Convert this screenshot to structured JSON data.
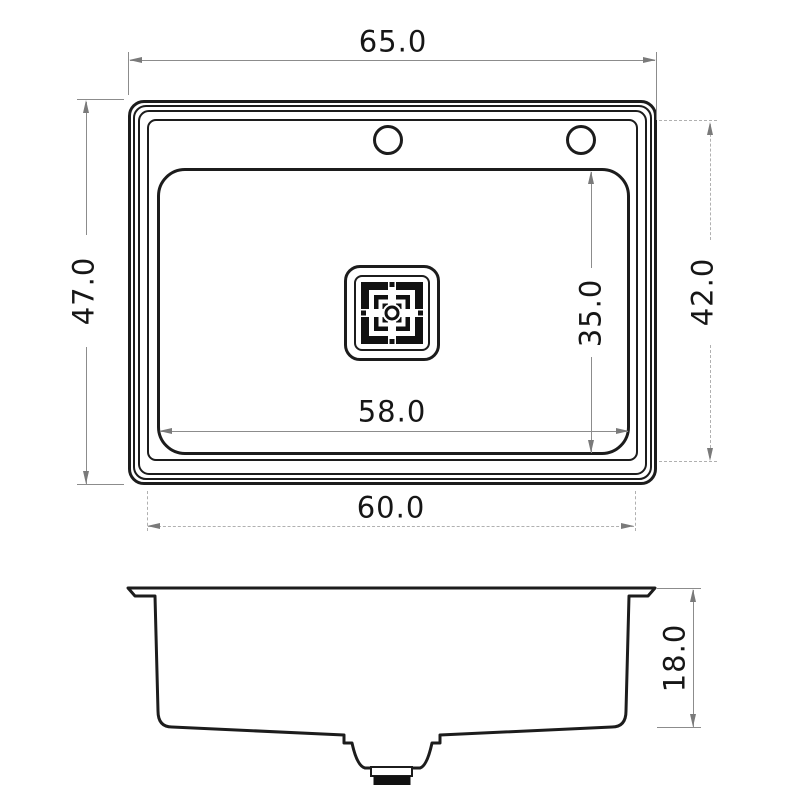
{
  "drawing": {
    "type": "sink-technical-drawing",
    "views": {
      "top": "top-view",
      "side": "side-section-view"
    },
    "units_note": "",
    "colors": {
      "object_line": "#1c1c1c",
      "dimension_line": "#8c8c8c",
      "dashed_line": "#b0b0b0",
      "arrow": "#7a7a7a",
      "text": "#161616",
      "background": "#ffffff",
      "drain_fill": "#111111"
    }
  },
  "dims": {
    "overall_width": "65.0",
    "overall_depth": "47.0",
    "rim_width": "60.0",
    "rim_depth": "42.0",
    "bowl_width": "58.0",
    "bowl_depth": "35.0",
    "side_height": "18.0"
  }
}
